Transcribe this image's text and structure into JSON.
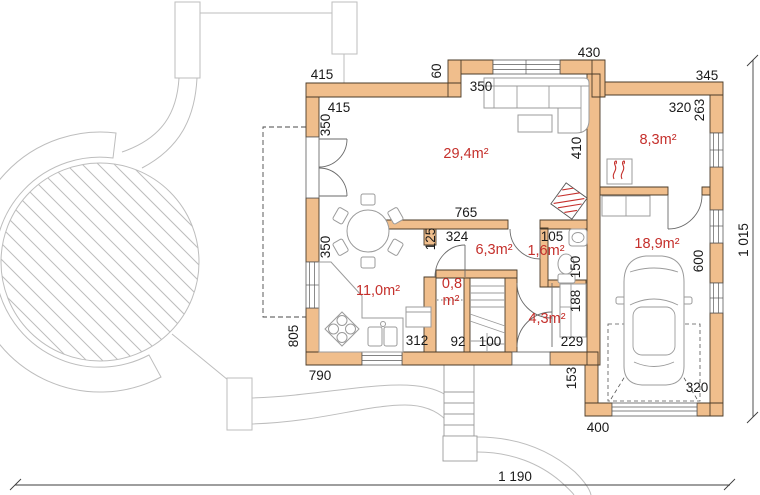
{
  "plan": {
    "type": "floor-plan",
    "colors": {
      "wall_fill": "#F0BE8C",
      "wall_outline": "#4A3B28",
      "dimension_text": "#1A1A1A",
      "room_area_text": "#C5302C",
      "furniture_stroke": "#9B9B9B",
      "landscape_stroke": "#BDBDBD"
    },
    "rooms": {
      "living": "29,4m²",
      "boiler_room": "8,3m²",
      "kitchen": "11,0m²",
      "hall": "6,3m²",
      "wc": "1,6m²",
      "garage": "18,9m²",
      "entry": "4,3m²",
      "closet_line1": "0,8",
      "closet_line2": "m²"
    },
    "dims": {
      "top_left": "415",
      "top_mid": "430",
      "top_right": "345",
      "step": "60",
      "top_window": "350",
      "inner_top": "415",
      "inner_top_v": "350",
      "living_width": "765",
      "living_height": "410",
      "boiler_width": "320",
      "boiler_depth": "263",
      "left_window": "350",
      "left_side": "805",
      "bottom_left": "790",
      "hall_v": "125",
      "hall_h": "324",
      "wc_door": "105",
      "wc_depth": "150",
      "closet_w": "92",
      "stairs_w": "100",
      "kitchen_bottom": "312",
      "entry_bottom": "229",
      "entry_nook": "188",
      "garage_depth": "600",
      "garage_door": "320",
      "garage_side": "153",
      "garage_bottom": "400",
      "overall_width": "1 190",
      "overall_height": "1 015"
    }
  }
}
